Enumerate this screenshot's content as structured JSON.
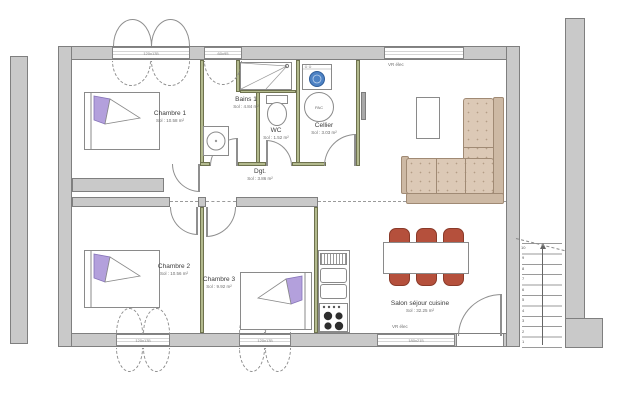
{
  "rooms": [
    {
      "name": "Chambre 1",
      "area": "Sol : 10.58 m²"
    },
    {
      "name": "Bains 1",
      "area": "Sol : 4.84 m²"
    },
    {
      "name": "WC",
      "area": "Sol : 1.52 m²"
    },
    {
      "name": "Cellier",
      "area": "Sol : 3.03 m²"
    },
    {
      "name": "Dgt.",
      "area": "Sol : 3.86 m²"
    },
    {
      "name": "Chambre 2",
      "area": "Sol : 10.56 m²"
    },
    {
      "name": "Chambre 3",
      "area": "Sol : 9.92 m²"
    },
    {
      "name": "Salon séjour cuisine",
      "area": "Sol : 32.25 m²"
    }
  ],
  "labels": {
    "vr_elec_top": "VR élec",
    "vr_elec_bottom": "VR élec",
    "pac": "PAC"
  },
  "windows": {
    "w1": "120x135",
    "w2": "60x95",
    "w4": "120x135",
    "w5": "120x135",
    "w6": "180x215"
  },
  "stairs": [
    "1",
    "2",
    "3",
    "4",
    "5",
    "6",
    "7",
    "8",
    "9",
    "10"
  ],
  "colors": {
    "wall_gray": "#c9c9c9",
    "partition_green": "#b3ba8e",
    "chair_red": "#b5503c",
    "sofa_beige": "#dcc9b6",
    "pillow_purple": "#b3a0dc",
    "washer_blue": "#4d82c4"
  }
}
